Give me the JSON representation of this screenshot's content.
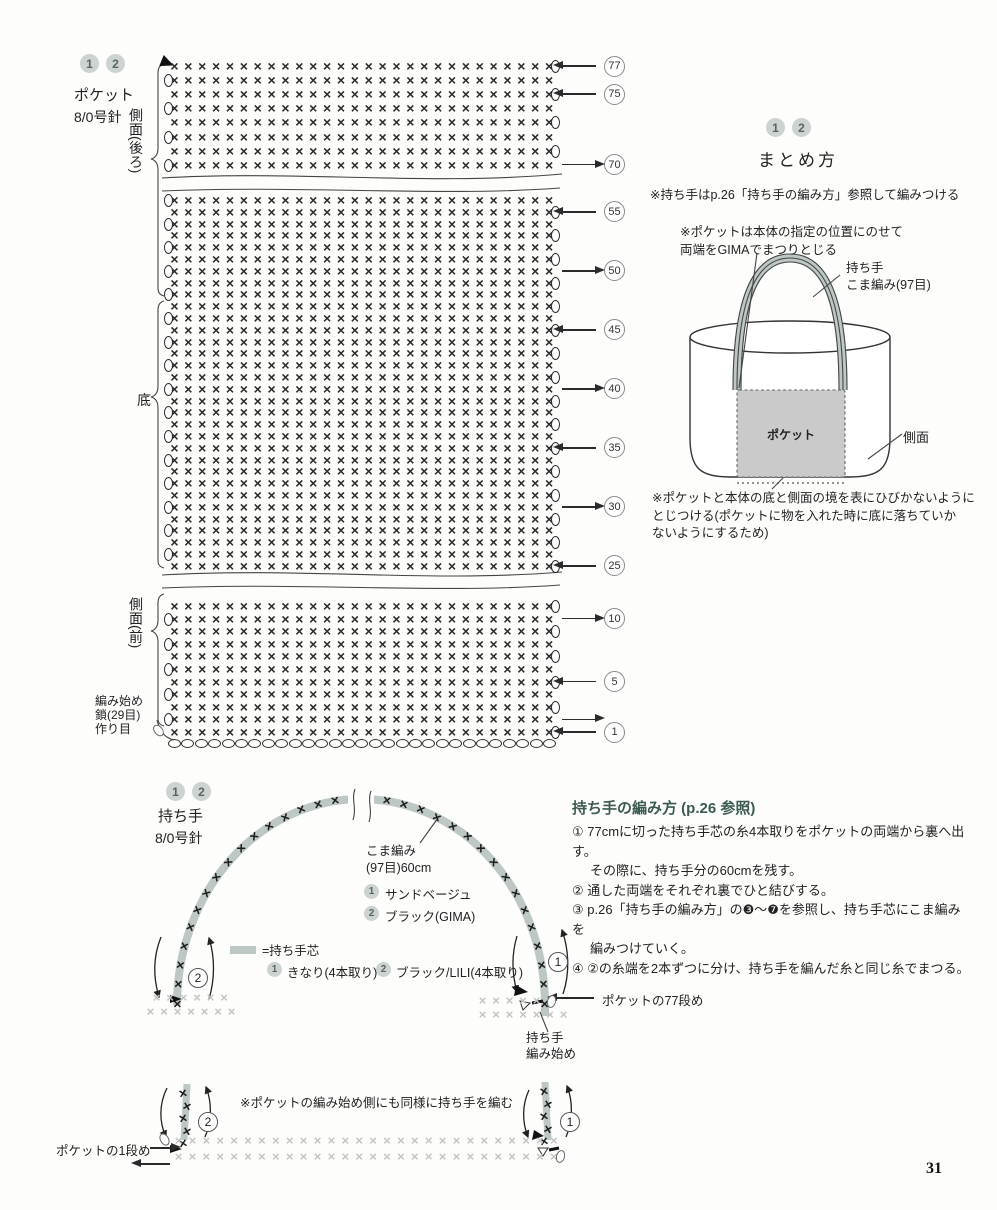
{
  "colors": {
    "ink": "#2b2b2b",
    "line": "#444444",
    "heading": "#3c5a52",
    "badge_bg": "#cdd3d1",
    "badge_text": "#5a6360",
    "band": "#bdc7c3",
    "pocket_fill": "#cacaca",
    "light": "#c4c4c4"
  },
  "page": {
    "number": "31"
  },
  "pocket": {
    "badges": [
      "1",
      "2"
    ],
    "title": "ポケット",
    "needle": "8/0号針",
    "label_back": "側面(後ろ)",
    "label_bottom": "底",
    "label_front": "側面(前)",
    "label_start": "編み始め\n鎖(29目)\n作り目",
    "stitch_symbol": "×",
    "columns": 28,
    "foundation_ovals": 29,
    "sections": [
      {
        "top": 60,
        "row_h": 14.1,
        "top_row": 77,
        "rows": 8,
        "markers": [
          {
            "row": 77,
            "dir": "left"
          },
          {
            "row": 75,
            "dir": "left"
          },
          {
            "row": 70,
            "dir": "right"
          }
        ]
      },
      {
        "top": 194,
        "row_h": 11.8,
        "top_row": 56,
        "rows": 32,
        "markers": [
          {
            "row": 55,
            "dir": "left"
          },
          {
            "row": 50,
            "dir": "right"
          },
          {
            "row": 45,
            "dir": "left"
          },
          {
            "row": 40,
            "dir": "right"
          },
          {
            "row": 35,
            "dir": "left"
          },
          {
            "row": 30,
            "dir": "right"
          },
          {
            "row": 25,
            "dir": "left"
          }
        ]
      },
      {
        "top": 600,
        "row_h": 12.6,
        "top_row": 11,
        "rows": 11,
        "markers": [
          {
            "row": 10,
            "dir": "right"
          },
          {
            "row": 5,
            "dir": "left"
          },
          {
            "row": 2,
            "dir": "right",
            "hide_number": true
          },
          {
            "row": 1,
            "dir": "left"
          }
        ]
      }
    ]
  },
  "assembly": {
    "badges": [
      "1",
      "2"
    ],
    "title": "まとめ方",
    "note1": "※持ち手はp.26「持ち手の編み方」参照して編みつける",
    "note2": "※ポケットは本体の指定の位置にのせて\n両端をGIMAでまつりとじる",
    "bag": {
      "handle_label": "持ち手\nこま編み(97目)",
      "pocket_label": "ポケット",
      "side_label": "側面"
    },
    "note3": "※ポケットと本体の底と側面の境を表にひびかないように\nとじつける(ポケットに物を入れた時に底に落ちていか\nないようにするため)"
  },
  "handle": {
    "badges": [
      "1",
      "2"
    ],
    "title": "持ち手",
    "needle": "8/0号針",
    "stitch_label": "こま編み\n(97目)60cm",
    "color1_num": "1",
    "color1": "サンドベージュ",
    "color2_num": "2",
    "color2": "ブラック(GIMA)",
    "legend_core": "=持ち手芯",
    "legend1_num": "1",
    "legend1": "きなり(4本取り)",
    "legend2_num": "2",
    "legend2": "ブラック/LILI(4本取り)",
    "circle_right": "1",
    "circle_left": "2",
    "row77_label": "ポケットの77段め",
    "start_label": "持ち手\n編み始め",
    "mini_note": "※ポケットの編み始め側にも同様に持ち手を編む",
    "row1_label": "ポケットの1段め",
    "mini_circle_left": "2",
    "mini_circle_right": "1",
    "arch": {
      "cx": 361,
      "cy": 1005,
      "rx": 184,
      "ry": 206,
      "count": 34,
      "gap_from": 0.465,
      "gap_to": 0.545
    },
    "stubs": [
      {
        "x": 185,
        "y0": 1086,
        "dy": 12.6,
        "count": 5
      },
      {
        "x": 546,
        "y0": 1084,
        "dy": 12.6,
        "count": 5
      }
    ],
    "strips": [
      {
        "x": 150,
        "y": 991,
        "step": 13.5,
        "count": 6
      },
      {
        "x": 144,
        "y": 1005,
        "step": 13.5,
        "count": 7
      },
      {
        "x": 476,
        "y": 994,
        "step": 13.5,
        "count": 6
      },
      {
        "x": 476,
        "y": 1008,
        "step": 13.5,
        "count": 7
      },
      {
        "x": 172,
        "y": 1134,
        "step": 13.9,
        "count": 28
      },
      {
        "x": 172,
        "y": 1150,
        "step": 13.9,
        "count": 28
      }
    ],
    "ovals": [
      {
        "x": 154,
        "y": 724,
        "rot": -40
      },
      {
        "x": 160,
        "y": 1133,
        "rot": -30
      },
      {
        "x": 556,
        "y": 1150,
        "rot": 15
      },
      {
        "x": 547,
        "y": 995,
        "rot": 15
      }
    ]
  },
  "instructions": {
    "title": "持ち手の編み方 (p.26 参照)",
    "steps": [
      {
        "text": "① 77cmに切った持ち手芯の糸4本取りをポケットの両端から裏へ出す。",
        "indent": false
      },
      {
        "text": "その際に、持ち手分の60cmを残す。",
        "indent": true
      },
      {
        "text": "② 通した両端をそれぞれ裏でひと結びする。",
        "indent": false
      },
      {
        "text": "③ p.26「持ち手の編み方」の❸〜❼を参照し、持ち手芯にこま編みを",
        "indent": false
      },
      {
        "text": "編みつけていく。",
        "indent": true
      },
      {
        "text": "④ ②の糸端を2本ずつに分け、持ち手を編んだ糸と同じ糸でまつる。",
        "indent": false
      }
    ]
  }
}
